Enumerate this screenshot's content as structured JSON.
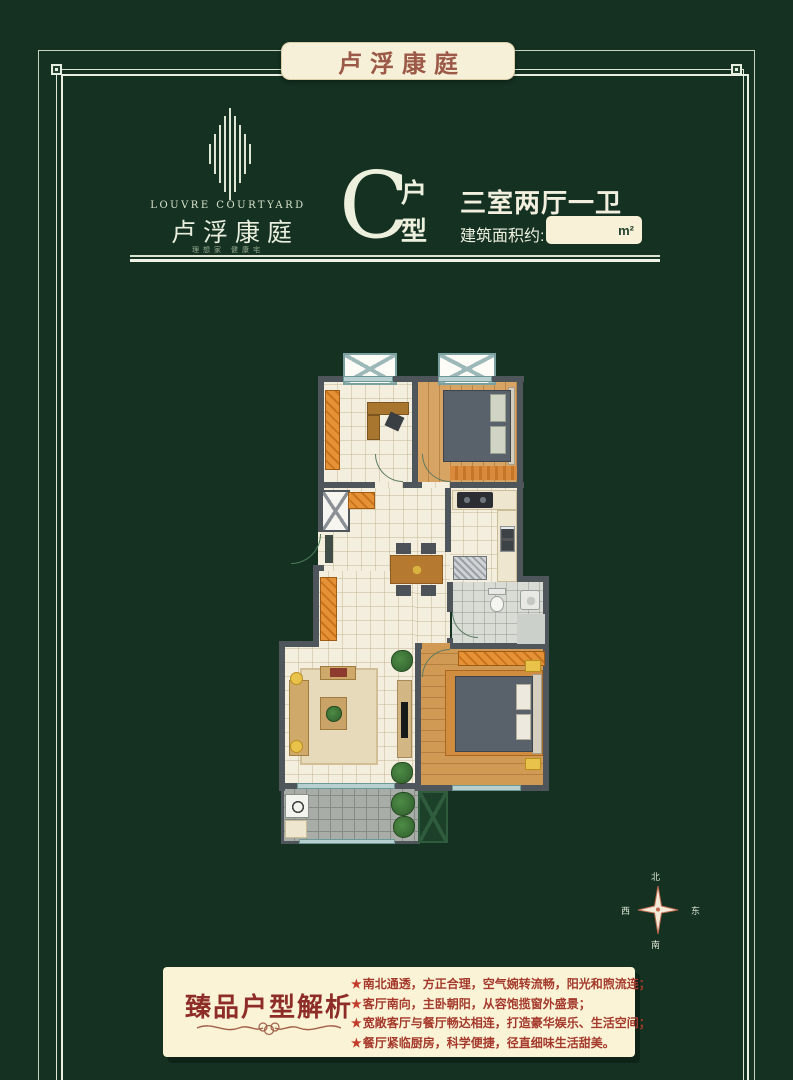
{
  "banner": {
    "title": "卢浮康庭"
  },
  "logo": {
    "name_en": "LOUVRE COURTYARD",
    "name_cn": "卢浮康庭",
    "tagline": "理想家 健康宅"
  },
  "unit": {
    "letter": "C",
    "suffix_top": "户",
    "suffix_bottom": "型",
    "layout": "三室两厅一卫",
    "area_label": "建筑面积约:",
    "area_value": "",
    "area_unit": "m²"
  },
  "compass": {
    "north": "北",
    "south": "南",
    "west": "西",
    "east": "东"
  },
  "analysis": {
    "title": "臻品户型解析",
    "bullet": "★",
    "points": [
      "南北通透，方正合理，空气婉转流畅，阳光和煦流连；",
      "客厅南向，主卧朝阳，从容饱揽窗外盛景；",
      "宽敞客厅与餐厅畅达相连，打造豪华娱乐、生活空间；",
      "餐厅紧临厨房，科学便捷，径直细味生活甜美。"
    ]
  },
  "colors": {
    "background": "#143122",
    "frame": "#e9efe0",
    "banner_bg": "#f7f0d8",
    "banner_text": "#9c5947",
    "headline_text": "#eef0de",
    "analysis_bg": "#faf3d6",
    "analysis_title": "#8e2c28",
    "analysis_text": "#a53a2c",
    "plan_wall": "#4e565b"
  }
}
